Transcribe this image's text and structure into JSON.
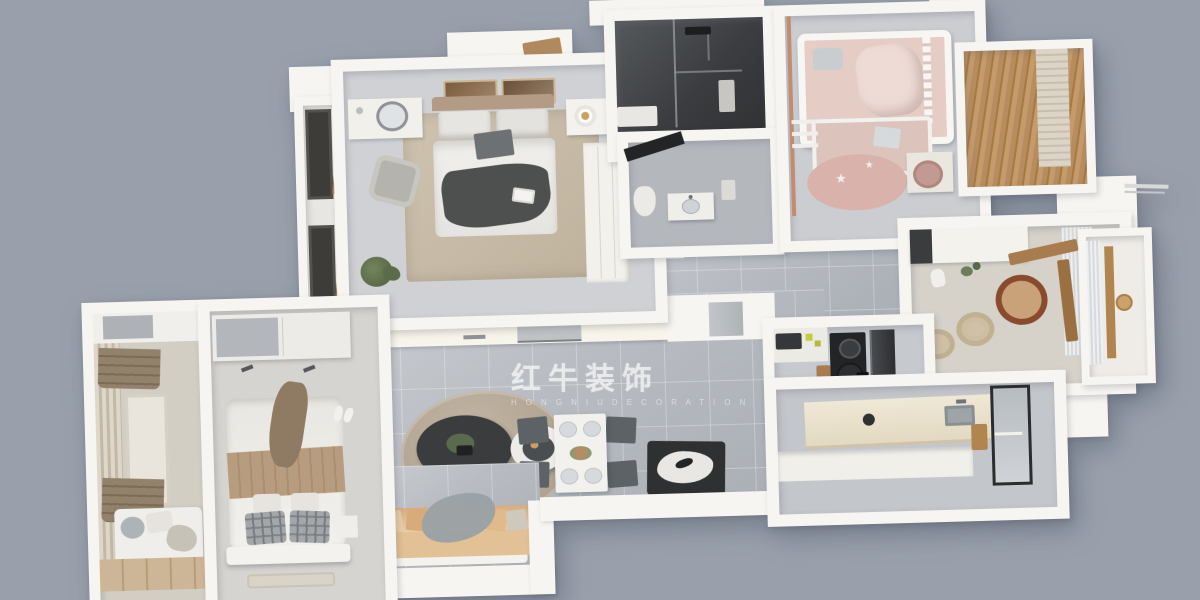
{
  "watermark": {
    "brand_cn": "红牛装饰",
    "brand_en": "H O N G   N I U   D E C O R A T I O N",
    "registered": "®",
    "logo": "bull-icon",
    "color": "rgba(255,255,255,0.6)"
  },
  "palette": {
    "bg": "#99a0ac",
    "wall": "#f7f5f1",
    "wall-shade": "#e4e2dd",
    "tile": "#b8bcc2",
    "floor-bedroom": "#cfd1d4",
    "floor-beige": "#d6d2ca",
    "rug-beige": "#c8bda9",
    "rug-living": "#b9ab99",
    "wood": "#a87c4e",
    "wood-light": "#c9b191",
    "copper": "#c48b71",
    "sofa-tan": "#e3c196",
    "pink": "#e0c2bb",
    "dark-table": "#3a3c3e",
    "shower-dark": "#44464a",
    "chair-gray": "#5d6267",
    "appliance-dark": "#232426"
  },
  "scene": {
    "type": "3d-floorplan-top-view",
    "rooms": [
      {
        "id": "master-bedroom",
        "furniture": [
          "double-bed",
          "dressing-desk",
          "mirror",
          "lounge-chair",
          "nightstand",
          "table-lamp",
          "wardrobe",
          "area-rug",
          "wall-art-frames",
          "plant",
          "bay-window"
        ]
      },
      {
        "id": "shower-room",
        "furniture": [
          "glass-partition",
          "shower-set",
          "ledge"
        ]
      },
      {
        "id": "bathroom",
        "furniture": [
          "vanity-sink",
          "toilet",
          "ceiling-beam"
        ]
      },
      {
        "id": "kids-room",
        "furniture": [
          "crib-bunk-bed",
          "lower-bed",
          "ladder",
          "star-rug",
          "kids-desk",
          "kids-chair",
          "copper-pole"
        ]
      },
      {
        "id": "kids-balcony",
        "furniture": [
          "wood-blinds",
          "side-panel"
        ]
      },
      {
        "id": "tea-room",
        "furniture": [
          "tall-cabinet",
          "window-desk",
          "armchair",
          "rattan-pouf",
          "rattan-pouf",
          "sheer-curtain",
          "plant"
        ]
      },
      {
        "id": "tea-window-bay",
        "furniture": [
          "wood-sill",
          "basket"
        ]
      },
      {
        "id": "kitchen",
        "furniture": [
          "upper-cabinets",
          "microwave",
          "cooktop",
          "fridge",
          "island-counter",
          "sink",
          "glass-door",
          "wood-shelf"
        ]
      },
      {
        "id": "corridor",
        "furniture": [
          "shoe-cabinet",
          "entry-door"
        ]
      },
      {
        "id": "living-dining-room",
        "furniture": [
          "tv-cabinet",
          "tv",
          "fridge-nook",
          "round-rug",
          "coffee-table-dark",
          "coffee-table-white",
          "dining-table",
          "dining-chairs-x4",
          "plates-x4",
          "flower-centerpiece",
          "art-bench",
          "sofa",
          "throw-blanket",
          "pillows"
        ]
      },
      {
        "id": "second-bedroom",
        "furniture": [
          "sliding-wardrobe",
          "double-bed",
          "plaid-pillows",
          "tan-blanket",
          "nightstand",
          "slippers",
          "bedside-rug"
        ]
      },
      {
        "id": "tatami-balcony",
        "furniture": [
          "top-shelf",
          "roman-blind",
          "roman-blind",
          "side-curtain",
          "daybed",
          "cushions",
          "wood-platform"
        ]
      }
    ]
  }
}
